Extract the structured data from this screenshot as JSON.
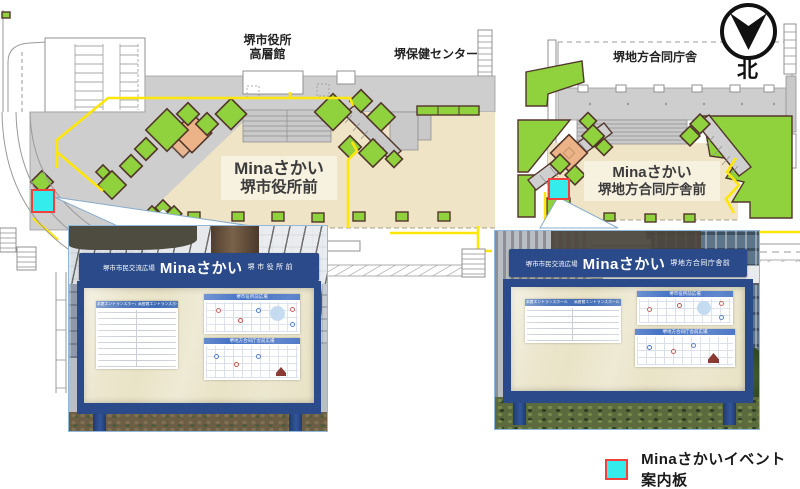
{
  "compass": {
    "label": "北"
  },
  "legend": {
    "label": "Minaさかいイベント案内板"
  },
  "left_map": {
    "building_top_line1": "堺市役所",
    "building_top_line2": "高層館",
    "building_right": "堺保健センター",
    "plaza_line1": "Minaさかい",
    "plaza_line2": "堺市役所前"
  },
  "right_map": {
    "building_top": "堺地方合同庁舎",
    "plaza_line1": "Minaさかい",
    "plaza_line2": "堺地方合同庁舎前"
  },
  "photos": {
    "left": {
      "site": "堺市市民交流広場",
      "brand": "Minaさかい",
      "place": "堺市役所前"
    },
    "right": {
      "site": "堺市市民交流広場",
      "brand": "Minaさかい",
      "place": "堺地方合同庁舎前"
    }
  },
  "papers": {
    "entrance_hall_main": "本館エントランスホール",
    "entrance_hall_tower": "高層館エントランスホール",
    "calendar_cityhall": "堺市役所前広場",
    "calendar_gov": "堺地方合同庁舎前広場"
  },
  "colors": {
    "marker-cyan": "#35ECEC",
    "marker-red": "#F0413C",
    "tree-green": "#8FD23E",
    "tree-outline": "#53362B",
    "plaza-beige": "#EFE5C6",
    "path-yellow": "#FFE60A",
    "paving-gray": "#CECECE",
    "board-navy": "#2A4A8A",
    "board-cream": "#E9E3C7"
  }
}
